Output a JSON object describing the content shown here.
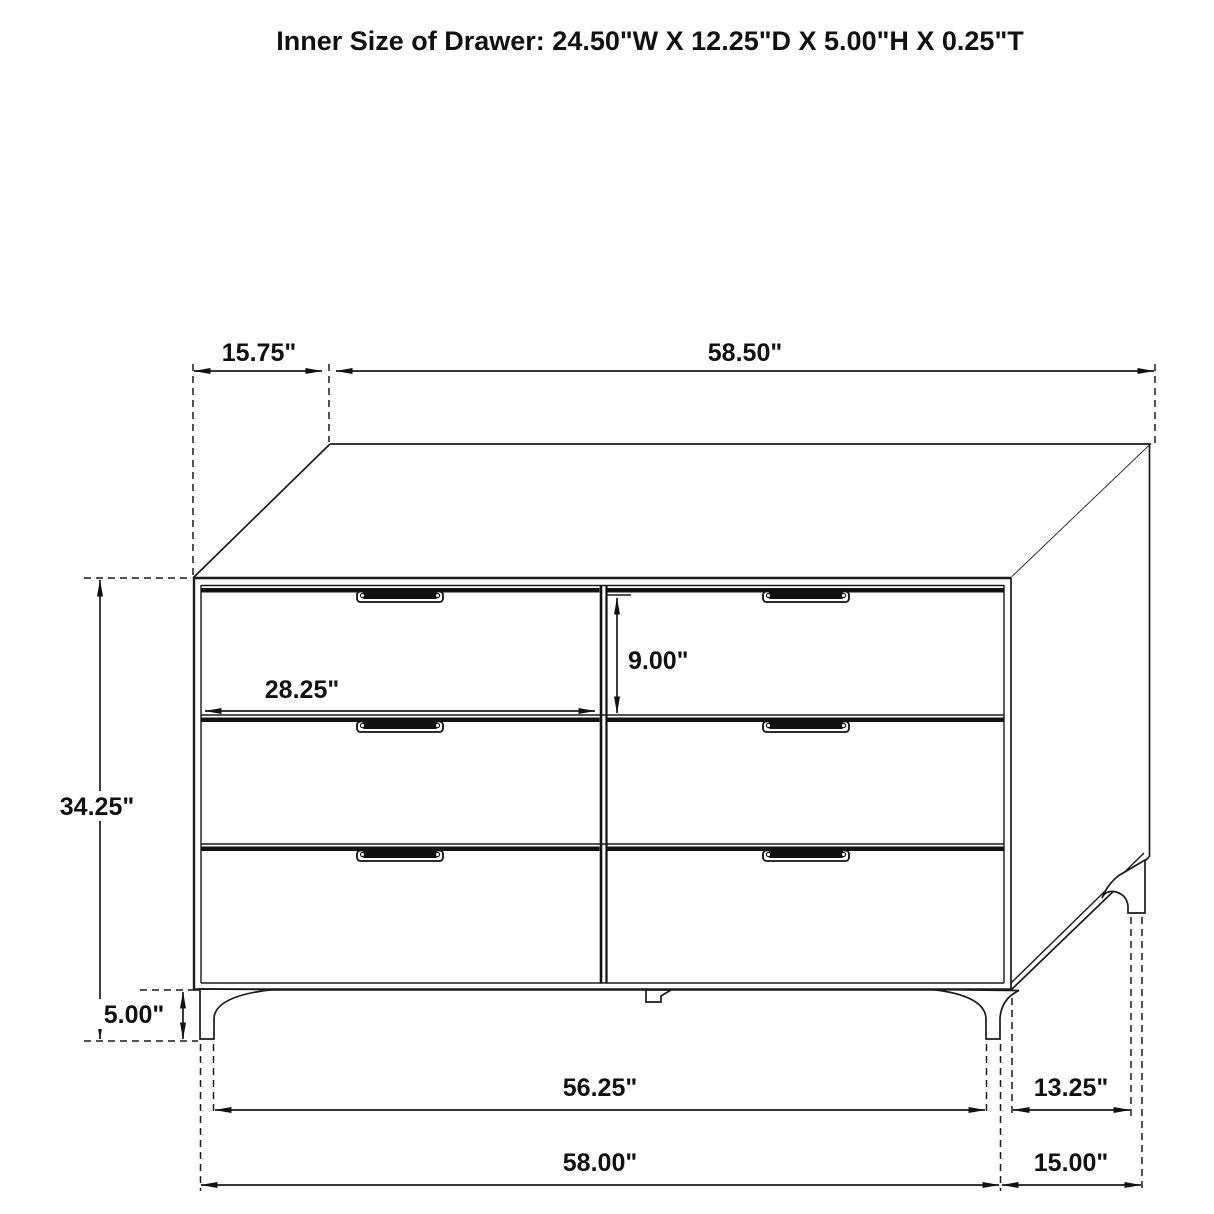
{
  "title": "Inner Size of Drawer: 24.50\"W X 12.25\"D X 5.00\"H X 0.25\"T",
  "dimensions": {
    "top_depth": "15.75\"",
    "top_width": "58.50\"",
    "overall_height": "34.25\"",
    "drawer_width": "28.25\"",
    "drawer_face_height": "9.00\"",
    "leg_height": "5.00\"",
    "base_inner_width": "56.25\"",
    "base_outer_width": "58.00\"",
    "side_inner_depth": "13.25\"",
    "side_outer_depth": "15.00\""
  },
  "line_color": "#1a1a1a",
  "background_color": "#ffffff"
}
